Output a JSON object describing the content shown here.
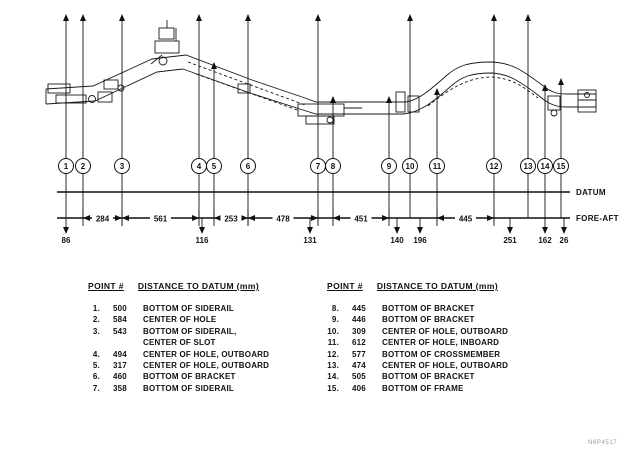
{
  "diagram": {
    "datum_label": "DATUM",
    "foreaft_label": "FORE-AFT",
    "points": [
      {
        "id": "1",
        "x": 66,
        "arrow_top": 14
      },
      {
        "id": "2",
        "x": 83,
        "arrow_top": 14
      },
      {
        "id": "3",
        "x": 122,
        "arrow_top": 14
      },
      {
        "id": "4",
        "x": 199,
        "arrow_top": 14
      },
      {
        "id": "5",
        "x": 214,
        "arrow_top": 62
      },
      {
        "id": "6",
        "x": 248,
        "arrow_top": 14
      },
      {
        "id": "7",
        "x": 318,
        "arrow_top": 14
      },
      {
        "id": "8",
        "x": 333,
        "arrow_top": 96
      },
      {
        "id": "9",
        "x": 389,
        "arrow_top": 96
      },
      {
        "id": "10",
        "x": 410,
        "arrow_top": 14
      },
      {
        "id": "11",
        "x": 437,
        "arrow_top": 88
      },
      {
        "id": "12",
        "x": 494,
        "arrow_top": 14
      },
      {
        "id": "13",
        "x": 528,
        "arrow_top": 14
      },
      {
        "id": "14",
        "x": 545,
        "arrow_top": 84
      },
      {
        "id": "15",
        "x": 561,
        "arrow_top": 78
      }
    ],
    "dimensions": [
      {
        "label": "284",
        "x1": 83,
        "x2": 122
      },
      {
        "label": "561",
        "x1": 122,
        "x2": 199
      },
      {
        "label": "253",
        "x1": 214,
        "x2": 248
      },
      {
        "label": "478",
        "x1": 248,
        "x2": 318
      },
      {
        "label": "451",
        "x1": 333,
        "x2": 389
      },
      {
        "label": "445",
        "x1": 437,
        "x2": 494
      }
    ],
    "offsets": [
      {
        "label": "86",
        "x": 66
      },
      {
        "label": "116",
        "x": 202
      },
      {
        "label": "131",
        "x": 310
      },
      {
        "label": "140",
        "x": 397
      },
      {
        "label": "196",
        "x": 420
      },
      {
        "label": "251",
        "x": 510
      },
      {
        "label": "162",
        "x": 545
      },
      {
        "label": "26",
        "x": 564
      }
    ]
  },
  "tables": [
    {
      "header_point": "POINT #",
      "header_dist": "DISTANCE TO DATUM (mm)",
      "rows": [
        {
          "num": "1.",
          "value": "500",
          "desc": "BOTTOM OF SIDERAIL"
        },
        {
          "num": "2.",
          "value": "584",
          "desc": "CENTER OF HOLE"
        },
        {
          "num": "3.",
          "value": "543",
          "desc": "BOTTOM OF SIDERAIL,",
          "desc2": "CENTER OF SLOT"
        },
        {
          "num": "4.",
          "value": "494",
          "desc": "CENTER OF HOLE, OUTBOARD"
        },
        {
          "num": "5.",
          "value": "317",
          "desc": "CENTER OF HOLE, OUTBOARD"
        },
        {
          "num": "6.",
          "value": "460",
          "desc": "BOTTOM OF BRACKET"
        },
        {
          "num": "7.",
          "value": "358",
          "desc": "BOTTOM OF SIDERAIL"
        }
      ]
    },
    {
      "header_point": "POINT #",
      "header_dist": "DISTANCE TO DATUM (mm)",
      "rows": [
        {
          "num": "8.",
          "value": "445",
          "desc": "BOTTOM OF BRACKET"
        },
        {
          "num": "9.",
          "value": "446",
          "desc": "BOTTOM OF BRACKET"
        },
        {
          "num": "10.",
          "value": "309",
          "desc": "CENTER OF HOLE, OUTBOARD"
        },
        {
          "num": "11.",
          "value": "612",
          "desc": "CENTER OF HOLE, INBOARD"
        },
        {
          "num": "12.",
          "value": "577",
          "desc": "BOTTOM OF CROSSMEMBER"
        },
        {
          "num": "13.",
          "value": "474",
          "desc": "CENTER OF HOLE, OUTBOARD"
        },
        {
          "num": "14.",
          "value": "505",
          "desc": "BOTTOM OF BRACKET"
        },
        {
          "num": "15.",
          "value": "406",
          "desc": "BOTTOM OF FRAME"
        }
      ]
    }
  ],
  "figure_code": "N6P4517"
}
